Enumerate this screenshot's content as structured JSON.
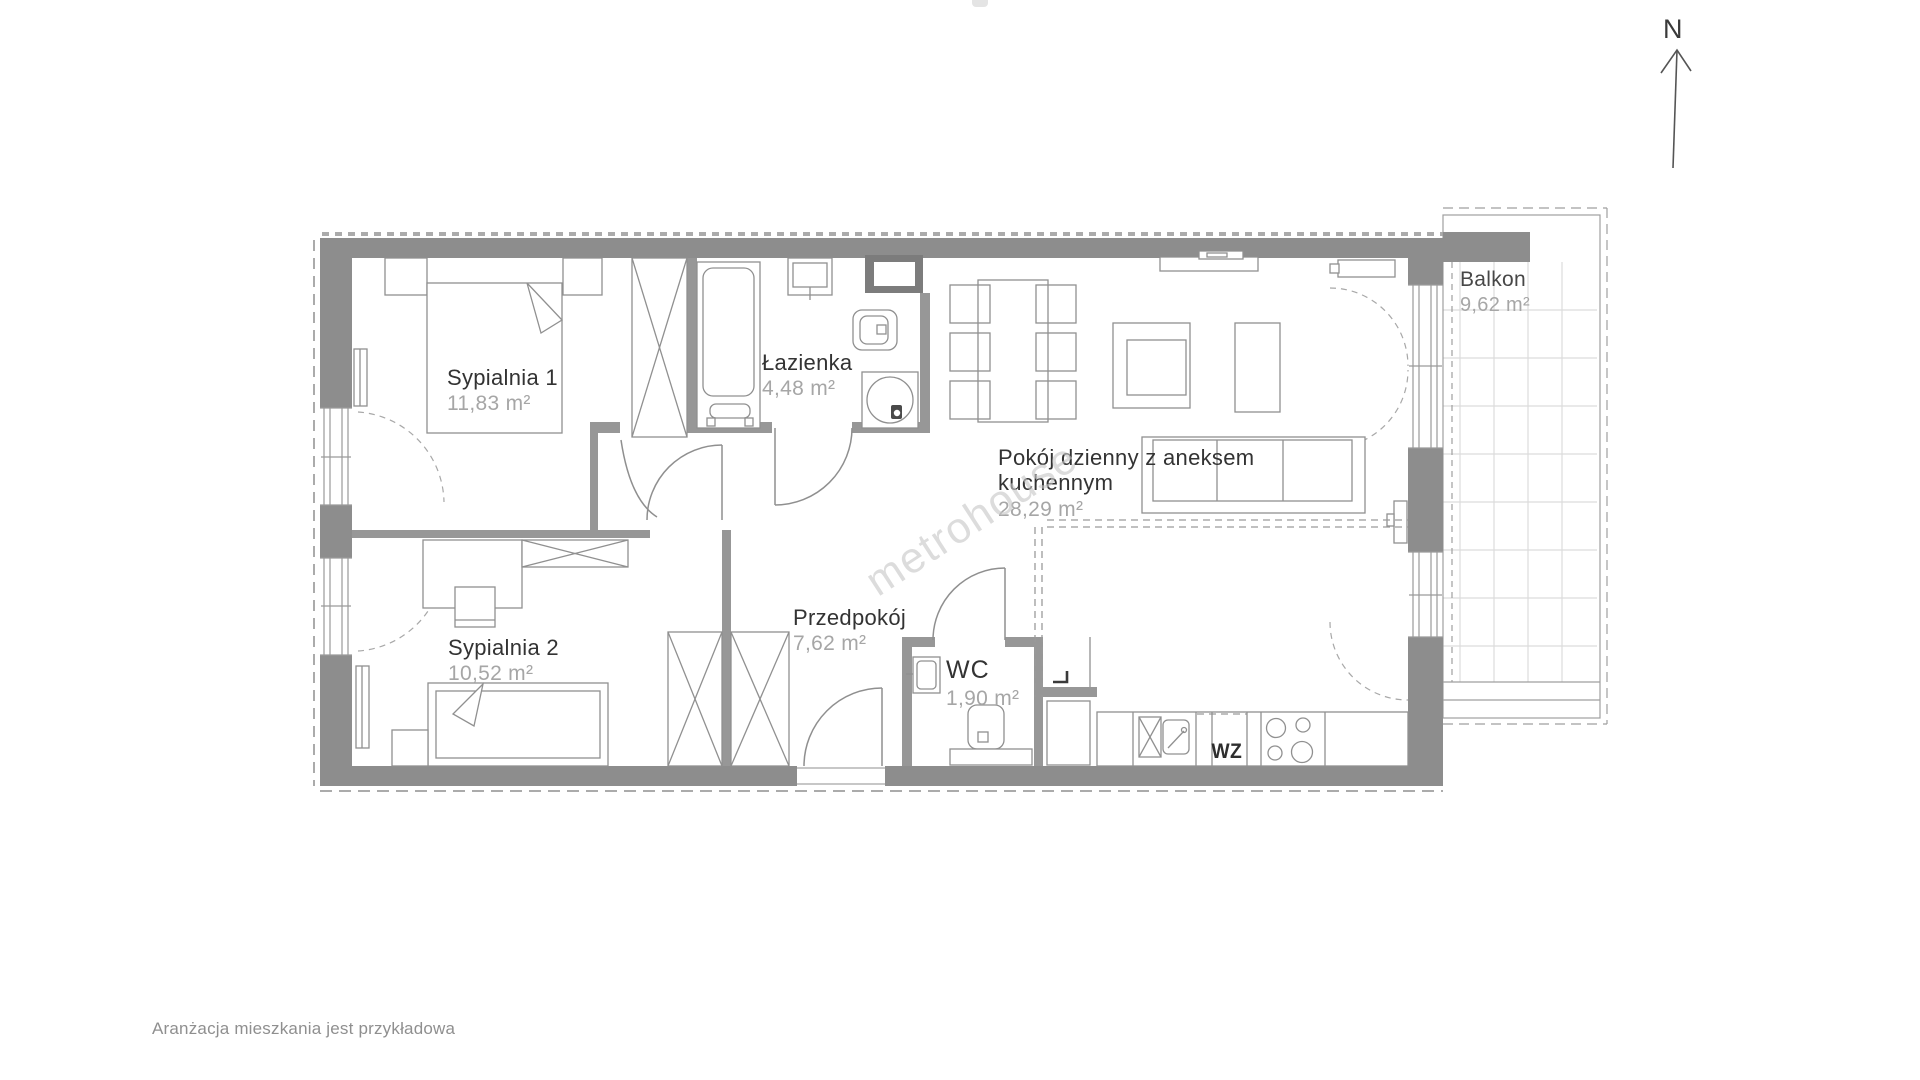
{
  "compass": {
    "label": "N"
  },
  "watermark": {
    "text": "metrohouse"
  },
  "disclaimer": {
    "text": "Aranżacja mieszkania jest przykładowa"
  },
  "kitchen": {
    "wz_label": "WZ"
  },
  "rooms": {
    "sypialnia1": {
      "name": "Sypialnia 1",
      "area": "11,83 m²"
    },
    "sypialnia2": {
      "name": "Sypialnia 2",
      "area": "10,52 m²"
    },
    "lazienka": {
      "name": "Łazienka",
      "area": "4,48 m²"
    },
    "przedpokoj": {
      "name": "Przedpokój",
      "area": "7,62 m²"
    },
    "wc": {
      "name": "WC",
      "area": "1,90 m²"
    },
    "pokoj": {
      "name_line1": "Pokój dzienny z aneksem",
      "name_line2": "kuchennym",
      "area": "28,29 m²"
    },
    "balkon": {
      "name": "Balkon",
      "area": "9,62 m²"
    }
  },
  "colors": {
    "wall": "#8d8d8d",
    "partition": "#979797",
    "shaft": "#7c7c7c",
    "line": "#8f8f8f",
    "glazing": "#9a9a9a",
    "tile": "#dcdcdc",
    "text_dark": "#333333",
    "text_muted": "#a6a6a6",
    "watermark": "#c7c7c7",
    "background": "#ffffff"
  }
}
